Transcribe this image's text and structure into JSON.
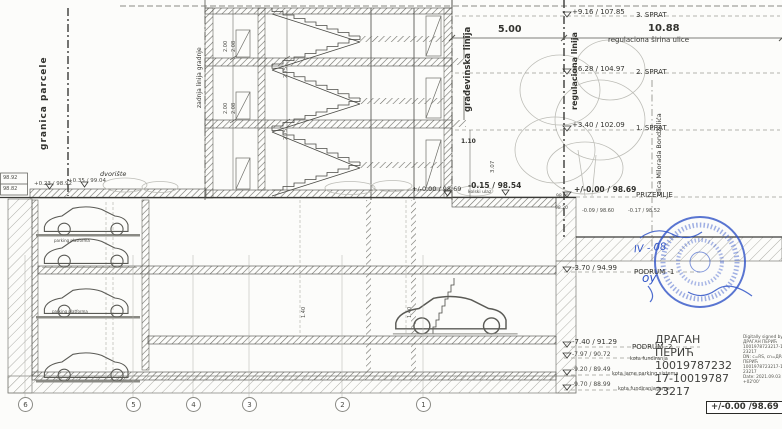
{
  "ref_lines": {
    "granica_parcele": "granica parcele",
    "zadnja_linija": "zadnja linija gradnje",
    "gradjevinska": "građevinska linija",
    "regulaciona": "regulaciona linija",
    "ulica": "ulica Milorada Bondžulića"
  },
  "top": {
    "dim_left": "5.00",
    "dim_right": "10.88",
    "street_width": "regulaciona širina ulice"
  },
  "levels": [
    {
      "elev": "+9.16 / 107.85",
      "name": "3. SPRAT"
    },
    {
      "elev": "+6.28 / 104.97",
      "name": "2. SPRAT"
    },
    {
      "elev": "+3.40 / 102.09",
      "name": "1. SPRAT"
    },
    {
      "elev": "+/-0.00 / 98.69",
      "name": "PRIZEMLJE"
    },
    {
      "elev": "-3.70 / 94.99",
      "name": "PODRUM -1"
    },
    {
      "elev": "-7.40 / 91.29",
      "name": "PODRUM -2"
    },
    {
      "elev": "-7.97 / 90.72",
      "name": "kota fundiranja"
    },
    {
      "elev": "-9.20 / 89.49",
      "name": "kota jame parking sistema"
    },
    {
      "elev": "-9.70 / 88.99",
      "name": "kota fundiranja jame"
    }
  ],
  "site": {
    "dvoriste": "dvorište",
    "spot_a": "98.92",
    "spot_b": "98.82",
    "yard_elev_a": "+0.23 / 98.92",
    "yard_elev_b": "+0.35 / 99.04",
    "entry_elev": "+/-0.00 / 98.69",
    "ramp_elev": "-0.15 / 98.54",
    "ramp_note": "kolski ulaz",
    "street_spot_a": "98.55",
    "street_spot_b": "98.20",
    "pavement_a": "-0.09 / 98.60",
    "pavement_b": "-0.17 / 98.52",
    "car_caption": "parking platforma"
  },
  "dims": {
    "h1": "2.00",
    "h2": "2.08",
    "h3": "2.75",
    "w1": "1.10",
    "h4": "3.07",
    "h5": "1.40"
  },
  "grid": [
    "6",
    "5",
    "4",
    "3",
    "2",
    "1"
  ],
  "signature": {
    "name": [
      "ДРАГАН",
      "ПЕРИЋ",
      "10019787232",
      "17-10019787",
      "23217"
    ],
    "details": [
      "Digitally signed by",
      "ДРАГАН ПЕРИЋ",
      "1001978723217-10019787",
      "23217",
      "DN: c=RS, cn=ДРАГАН",
      "ПЕРИЋ",
      "1001978723217-10019787",
      "23217",
      "Date: 2021.09.03 16:23:08",
      "+02'00'"
    ]
  },
  "stamp": {
    "note_a": "IV - 08",
    "note_b": "оу"
  },
  "datum_box": "+/-0.00 /98.69"
}
